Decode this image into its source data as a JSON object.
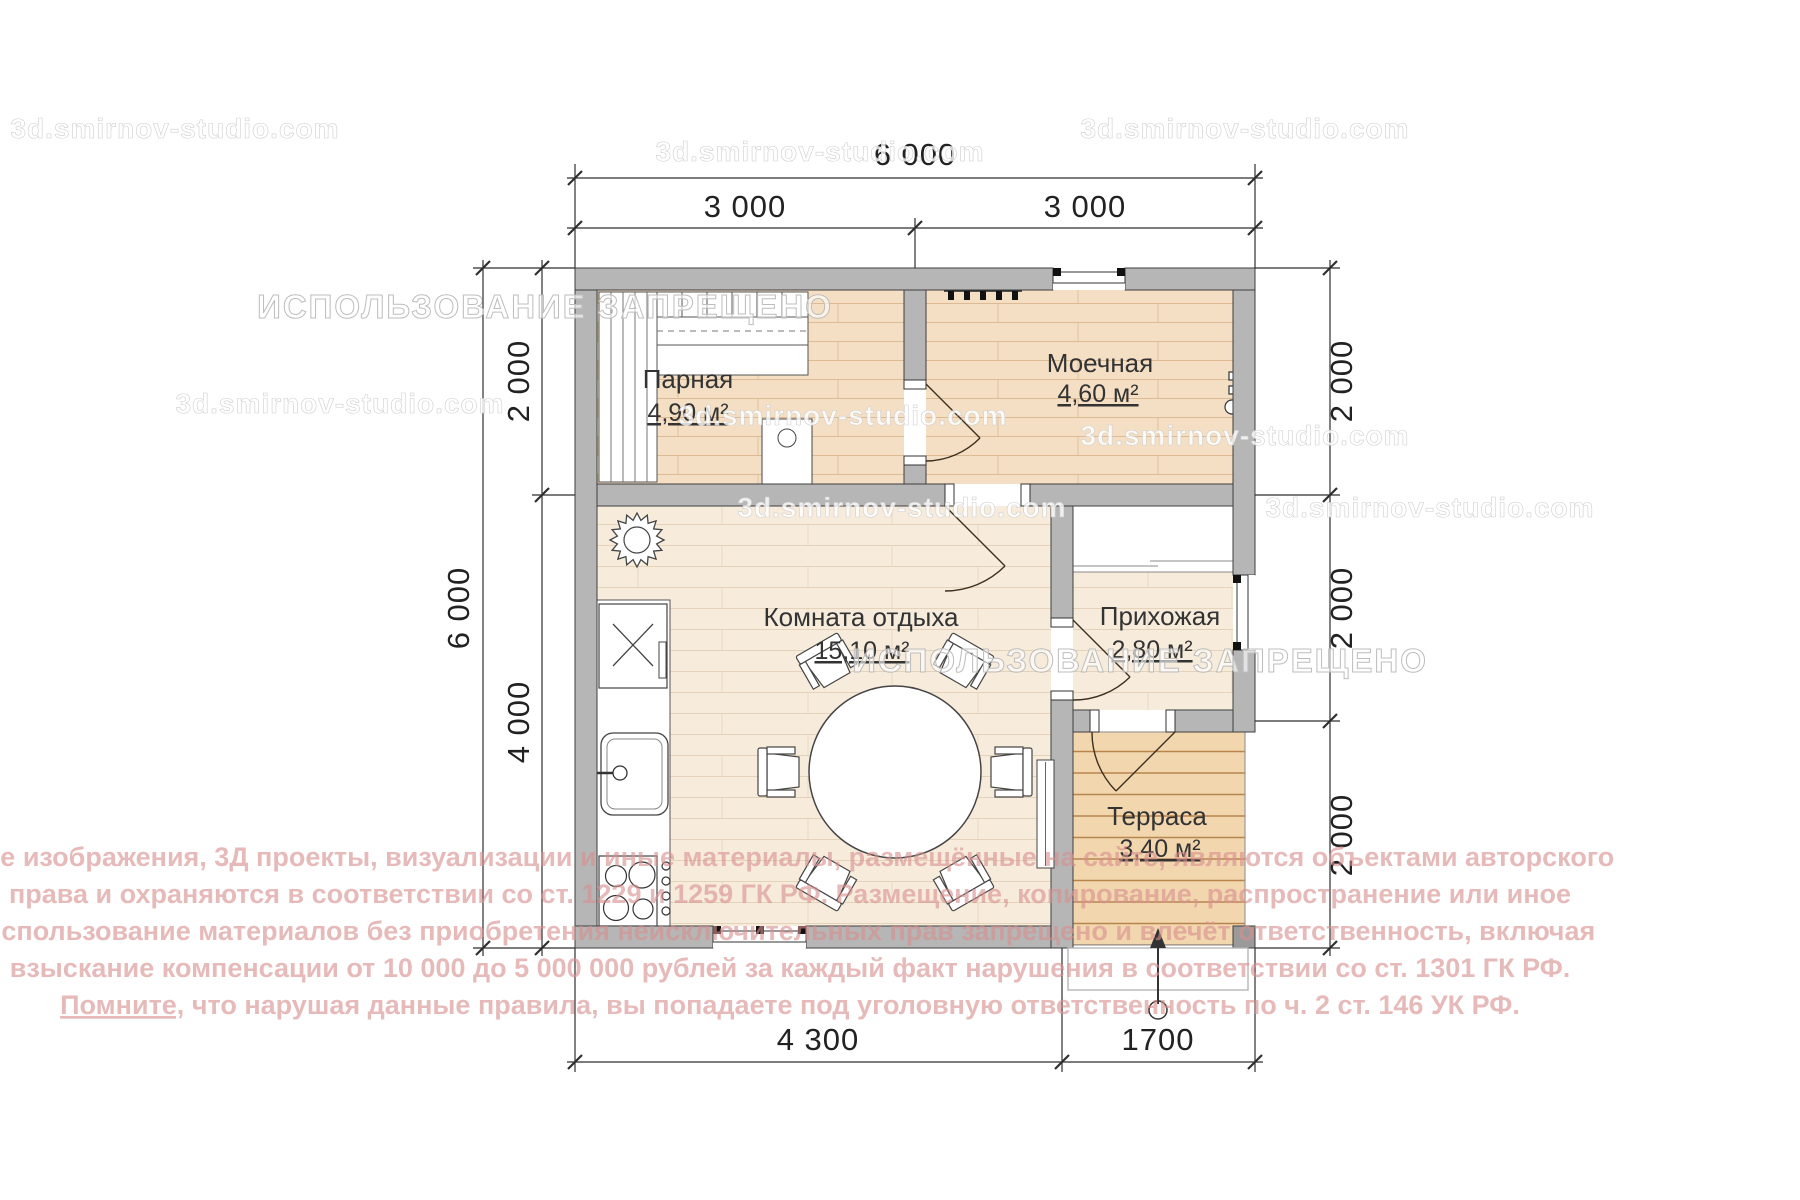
{
  "palette": {
    "wall_fill": "#b6b6b6",
    "wall_stroke": "#3e3e3e",
    "bath_floor": "#f4dfc4",
    "bath_plank_line": "#dcba93",
    "main_floor": "#f7ecdc",
    "main_plank_line": "#e4d3b9",
    "terrace_floor": "#f1d6ae",
    "terrace_plank_line": "#b9854e",
    "label_color": "#3a3a3a",
    "copyright_pink": "#d98f8f",
    "watermark_white": "#ffffff"
  },
  "rooms": {
    "parnaya": {
      "name": "Парная",
      "area": "4,90 м²"
    },
    "moechnaya": {
      "name": "Моечная",
      "area": "4,60 м²"
    },
    "komnata": {
      "name": "Комната отдыха",
      "area": "15,10 м²"
    },
    "prihozhaya": {
      "name": "Прихожая",
      "area": "2,80 м²"
    },
    "terrasa": {
      "name": "Терраса",
      "area": "3,40 м²"
    }
  },
  "dimensions": {
    "top_total": "6 000",
    "top_left": "3 000",
    "top_right": "3 000",
    "left_total": "6 000",
    "left_top": "2 000",
    "left_bottom": "4 000",
    "right_top": "2 000",
    "right_middle": "2 000",
    "right_bottom": "2 000",
    "bottom_left": "4 300",
    "bottom_right": "1700"
  },
  "watermarks": {
    "site": "3d.smirnov-studio.com",
    "forbidden": "ИСПОЛЬЗОВАНИЕ ЗАПРЕЩЕНО"
  },
  "copyright": {
    "line1": "Все изображения, 3Д проекты, визуализации и иные материалы, размещённые на сайте, являются объектами авторского",
    "line2": "права и охраняются в соответствии со ст. 1229 и 1259 ГК РФ. Размещение, копирование, распространение или иное",
    "line3": "использование материалов без приобретения неисключительных прав запрещено и влечёт ответственность, включая",
    "line4": "взыскание компенсации от 10 000 до 5 000 000 рублей за каждый факт нарушения в соответствии со ст. 1301 ГК РФ.",
    "line5_underlined": "Помните,",
    "line5_rest": " что нарушая данные правила, вы попадаете под уголовную ответственность по ч. 2 ст. 146 УК РФ."
  }
}
